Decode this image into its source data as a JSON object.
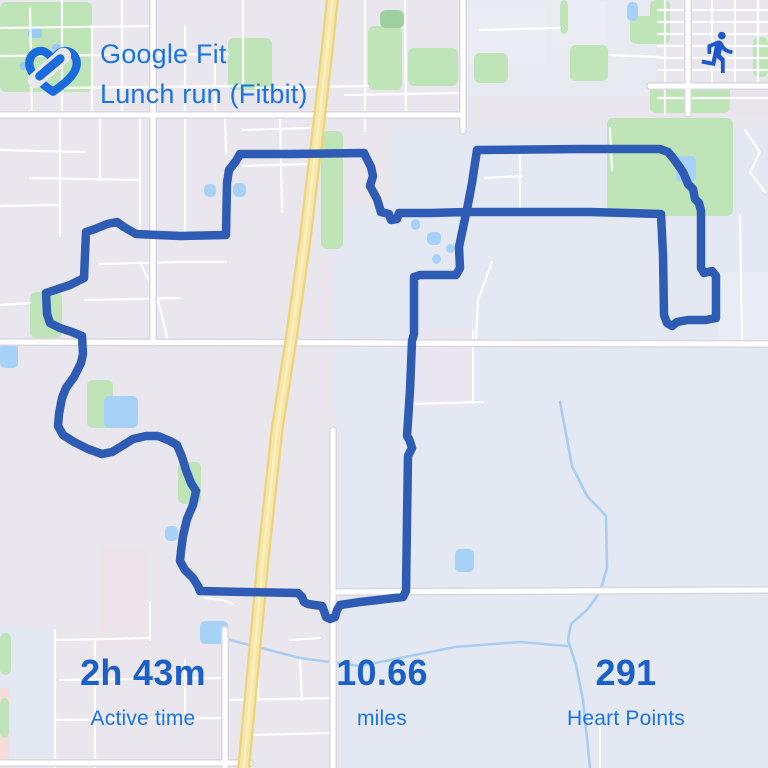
{
  "header": {
    "app_title": "Google Fit",
    "activity_title": "Lunch run (Fitbit)"
  },
  "icons": {
    "logo": "google-fit-heart-icon",
    "badge": "run-icon"
  },
  "stats": [
    {
      "value": "2h 43m",
      "label": "Active time"
    },
    {
      "value": "10.66",
      "label": "miles"
    },
    {
      "value": "291",
      "label": "Heart Points"
    }
  ],
  "colors": {
    "title_blue": "#1A73E8",
    "value_blue": "#1B5FC8",
    "label_blue": "#1A73E8",
    "logo_blue": "#1A6BDE",
    "run_icon_blue": "#1D57C9",
    "route_blue": "#2E5BB4",
    "map_base": "#E9E6EE",
    "map_water": "#A7D2F7",
    "map_park": "#BEE4B8",
    "map_road": "#FFFFFF",
    "map_road_casing": "#DBD7E1",
    "map_highway": "#F7E7A4",
    "map_highway_casing": "#EDD27F"
  },
  "map": {
    "zones": [
      [
        0,
        0,
        768,
        768,
        "#E9E6EE"
      ],
      [
        333,
        205,
        435,
        563,
        "#E3E8F2"
      ],
      [
        390,
        128,
        378,
        80,
        "#E4E8F2"
      ],
      [
        460,
        0,
        200,
        96,
        "#E8EAF2"
      ],
      [
        656,
        0,
        112,
        114,
        "#E8E5ED"
      ],
      [
        552,
        2,
        54,
        44,
        "#ECECF4"
      ],
      [
        468,
        8,
        78,
        56,
        "#ECECF4"
      ],
      [
        408,
        330,
        64,
        76,
        "#E9E6EF"
      ],
      [
        718,
        272,
        50,
        70,
        "#EAECF3"
      ],
      [
        0,
        628,
        55,
        140,
        "#E4E8F2"
      ],
      [
        0,
        688,
        10,
        80,
        "#F5DEDA"
      ],
      [
        100,
        547,
        45,
        100,
        "#ECE4E9"
      ]
    ],
    "parks": [
      [
        0,
        2,
        92,
        90
      ],
      [
        228,
        38,
        44,
        52
      ],
      [
        368,
        26,
        34,
        64
      ],
      [
        380,
        10,
        24,
        18,
        "#9FD09F"
      ],
      [
        408,
        48,
        50,
        38
      ],
      [
        474,
        53,
        34,
        30
      ],
      [
        560,
        0,
        8,
        34
      ],
      [
        630,
        16,
        28,
        28
      ],
      [
        570,
        45,
        38,
        36
      ],
      [
        607,
        118,
        126,
        98
      ],
      [
        650,
        0,
        20,
        44
      ],
      [
        753,
        37,
        15,
        40
      ],
      [
        650,
        85,
        80,
        28
      ],
      [
        321,
        131,
        22,
        118
      ],
      [
        30,
        292,
        32,
        46
      ],
      [
        87,
        380,
        26,
        48
      ],
      [
        178,
        462,
        23,
        42
      ],
      [
        0,
        633,
        11,
        42
      ],
      [
        0,
        698,
        9,
        40
      ]
    ],
    "ponds": [
      [
        676,
        156,
        20,
        26
      ],
      [
        627,
        2,
        11,
        19
      ],
      [
        0,
        343,
        18,
        25
      ],
      [
        104,
        396,
        34,
        32
      ],
      [
        165,
        526,
        13,
        15
      ],
      [
        200,
        621,
        28,
        23
      ],
      [
        455,
        549,
        19,
        23
      ],
      [
        427,
        232,
        14,
        13
      ],
      [
        446,
        244,
        9,
        9
      ],
      [
        432,
        254,
        9,
        10
      ],
      [
        411,
        219,
        9,
        11
      ],
      [
        204,
        184,
        12,
        13
      ],
      [
        233,
        183,
        13,
        14
      ]
    ],
    "pond_specks": [
      [
        28,
        28,
        14,
        10
      ],
      [
        52,
        44,
        10,
        8
      ],
      [
        20,
        62,
        9,
        8
      ]
    ],
    "creeks": [
      [
        [
          560,
          402
        ],
        [
          572,
          466
        ],
        [
          587,
          496
        ],
        [
          606,
          516
        ],
        [
          607,
          568
        ],
        [
          600,
          592
        ],
        [
          588,
          609
        ],
        [
          571,
          624
        ],
        [
          568,
          640
        ],
        [
          576,
          665
        ],
        [
          583,
          700
        ],
        [
          590,
          768
        ]
      ],
      [
        [
          410,
          656
        ],
        [
          455,
          647
        ],
        [
          520,
          642
        ],
        [
          567,
          646
        ]
      ],
      [
        [
          230,
          640
        ],
        [
          300,
          658
        ],
        [
          360,
          666
        ],
        [
          410,
          656
        ]
      ]
    ],
    "roads_minor": [
      [
        [
          0,
          28
        ],
        [
          150,
          26
        ]
      ],
      [
        [
          0,
          56
        ],
        [
          228,
          54
        ]
      ],
      [
        [
          60,
          88
        ],
        [
          240,
          86
        ]
      ],
      [
        [
          30,
          8
        ],
        [
          32,
          115
        ]
      ],
      [
        [
          62,
          0
        ],
        [
          62,
          115
        ]
      ],
      [
        [
          92,
          26
        ],
        [
          92,
          115
        ]
      ],
      [
        [
          122,
          0
        ],
        [
          122,
          115
        ]
      ],
      [
        [
          185,
          26
        ],
        [
          185,
          115
        ]
      ],
      [
        [
          215,
          54
        ],
        [
          215,
          115
        ]
      ],
      [
        [
          243,
          0
        ],
        [
          243,
          88
        ]
      ],
      [
        [
          0,
          150
        ],
        [
          85,
          152
        ]
      ],
      [
        [
          30,
          178
        ],
        [
          140,
          180
        ]
      ],
      [
        [
          0,
          206
        ],
        [
          60,
          205
        ]
      ],
      [
        [
          60,
          115
        ],
        [
          60,
          236
        ]
      ],
      [
        [
          100,
          115
        ],
        [
          100,
          180
        ]
      ],
      [
        [
          140,
          115
        ],
        [
          140,
          236
        ]
      ],
      [
        [
          185,
          115
        ],
        [
          185,
          236
        ]
      ],
      [
        [
          100,
          264
        ],
        [
          180,
          262
        ],
        [
          226,
          262
        ]
      ],
      [
        [
          85,
          300
        ],
        [
          180,
          298
        ]
      ],
      [
        [
          140,
          262
        ],
        [
          158,
          300
        ],
        [
          168,
          341
        ]
      ],
      [
        [
          225,
          115
        ],
        [
          226,
          154
        ]
      ],
      [
        [
          280,
          115
        ],
        [
          282,
          212
        ]
      ],
      [
        [
          243,
          130
        ],
        [
          310,
          128
        ]
      ],
      [
        [
          243,
          166
        ],
        [
          308,
          164
        ]
      ],
      [
        [
          365,
          0
        ],
        [
          365,
          131
        ]
      ],
      [
        [
          405,
          0
        ],
        [
          406,
          115
        ]
      ],
      [
        [
          255,
          88
        ],
        [
          368,
          86
        ]
      ],
      [
        [
          345,
          95
        ],
        [
          463,
          93
        ]
      ],
      [
        [
          480,
          30
        ],
        [
          560,
          28
        ]
      ],
      [
        [
          610,
          55
        ],
        [
          660,
          57
        ]
      ],
      [
        [
          658,
          10
        ],
        [
          768,
          10
        ]
      ],
      [
        [
          658,
          22
        ],
        [
          768,
          22
        ]
      ],
      [
        [
          658,
          34
        ],
        [
          768,
          34
        ]
      ],
      [
        [
          658,
          46
        ],
        [
          768,
          46
        ]
      ],
      [
        [
          658,
          58
        ],
        [
          768,
          58
        ]
      ],
      [
        [
          658,
          70
        ],
        [
          768,
          70
        ]
      ],
      [
        [
          658,
          98
        ],
        [
          768,
          98
        ]
      ],
      [
        [
          712,
          0
        ],
        [
          712,
          86
        ]
      ],
      [
        [
          735,
          0
        ],
        [
          735,
          86
        ]
      ],
      [
        [
          758,
          0
        ],
        [
          758,
          86
        ]
      ],
      [
        [
          665,
          0
        ],
        [
          665,
          114
        ]
      ],
      [
        [
          520,
          150
        ],
        [
          520,
          212
        ]
      ],
      [
        [
          485,
          178
        ],
        [
          522,
          176
        ]
      ],
      [
        [
          610,
          128
        ],
        [
          612,
          170
        ]
      ],
      [
        [
          740,
          215
        ],
        [
          742,
          340
        ]
      ],
      [
        [
          745,
          130
        ],
        [
          760,
          152
        ],
        [
          750,
          172
        ],
        [
          765,
          192
        ]
      ],
      [
        [
          492,
          262
        ],
        [
          478,
          300
        ],
        [
          476,
          341
        ]
      ],
      [
        [
          408,
          404
        ],
        [
          483,
          402
        ]
      ],
      [
        [
          473,
          330
        ],
        [
          473,
          403
        ]
      ],
      [
        [
          95,
          640
        ],
        [
          95,
          768
        ]
      ],
      [
        [
          55,
          640
        ],
        [
          150,
          638
        ]
      ],
      [
        [
          60,
          680
        ],
        [
          225,
          678
        ]
      ],
      [
        [
          55,
          720
        ],
        [
          225,
          718
        ]
      ],
      [
        [
          150,
          602
        ],
        [
          150,
          640
        ]
      ],
      [
        [
          185,
          660
        ],
        [
          185,
          720
        ]
      ],
      [
        [
          258,
          630
        ],
        [
          258,
          700
        ]
      ],
      [
        [
          230,
          700
        ],
        [
          330,
          698
        ]
      ],
      [
        [
          250,
          735
        ],
        [
          333,
          733
        ]
      ],
      [
        [
          205,
          598
        ],
        [
          222,
          600
        ],
        [
          233,
          604
        ]
      ],
      [
        [
          290,
          640
        ],
        [
          320,
          638
        ]
      ],
      [
        [
          300,
          660
        ],
        [
          302,
          700
        ]
      ],
      [
        [
          600,
          714
        ],
        [
          600,
          768
        ]
      ],
      [
        [
          55,
          630
        ],
        [
          55,
          768
        ]
      ],
      [
        [
          0,
          305
        ],
        [
          30,
          303
        ]
      ]
    ],
    "roads_major": [
      [
        [
          0,
          115
        ],
        [
          463,
          115
        ]
      ],
      [
        [
          650,
          86
        ],
        [
          768,
          86
        ]
      ],
      [
        [
          0,
          342
        ],
        [
          768,
          344
        ]
      ],
      [
        [
          333,
          592
        ],
        [
          768,
          590
        ]
      ],
      [
        [
          0,
          763
        ],
        [
          250,
          763
        ]
      ],
      [
        [
          153,
          0
        ],
        [
          153,
          343
        ]
      ],
      [
        [
          463,
          0
        ],
        [
          463,
          131
        ]
      ],
      [
        [
          688,
          0
        ],
        [
          688,
          114
        ]
      ],
      [
        [
          333,
          430
        ],
        [
          333,
          768
        ]
      ],
      [
        [
          225,
          630
        ],
        [
          225,
          768
        ]
      ]
    ],
    "highway": [
      [
        333,
        -6
      ],
      [
        326,
        60
      ],
      [
        318,
        130
      ],
      [
        305,
        240
      ],
      [
        291,
        340
      ],
      [
        277,
        430
      ],
      [
        263,
        560
      ],
      [
        251,
        690
      ],
      [
        243,
        775
      ]
    ],
    "route": [
      [
        477,
        150
      ],
      [
        580,
        149
      ],
      [
        660,
        149
      ],
      [
        668,
        152
      ],
      [
        673,
        158
      ],
      [
        681,
        169
      ],
      [
        684,
        174
      ],
      [
        688,
        184
      ],
      [
        693,
        189
      ],
      [
        695,
        199
      ],
      [
        699,
        203
      ],
      [
        701,
        211
      ],
      [
        701,
        245
      ],
      [
        701,
        268
      ],
      [
        704,
        273
      ],
      [
        712,
        271
      ],
      [
        716,
        276
      ],
      [
        716,
        318
      ],
      [
        706,
        320
      ],
      [
        688,
        320
      ],
      [
        677,
        322
      ],
      [
        672,
        326
      ],
      [
        667,
        323
      ],
      [
        664,
        315
      ],
      [
        663,
        255
      ],
      [
        661,
        214
      ],
      [
        590,
        212
      ],
      [
        480,
        212
      ],
      [
        466,
        212
      ],
      [
        430,
        213
      ],
      [
        399,
        213
      ],
      [
        397,
        219
      ],
      [
        391,
        220
      ],
      [
        389,
        214
      ],
      [
        381,
        212
      ],
      [
        377,
        199
      ],
      [
        370,
        186
      ],
      [
        373,
        176
      ],
      [
        371,
        167
      ],
      [
        364,
        153
      ],
      [
        290,
        154
      ],
      [
        240,
        154
      ],
      [
        236,
        161
      ],
      [
        229,
        170
      ],
      [
        227,
        183
      ],
      [
        226,
        235
      ],
      [
        180,
        236
      ],
      [
        136,
        234
      ],
      [
        124,
        227
      ],
      [
        117,
        222
      ],
      [
        107,
        224
      ],
      [
        95,
        229
      ],
      [
        86,
        232
      ],
      [
        84,
        278
      ],
      [
        70,
        285
      ],
      [
        55,
        290
      ],
      [
        46,
        293
      ],
      [
        47,
        314
      ],
      [
        50,
        323
      ],
      [
        60,
        328
      ],
      [
        72,
        332
      ],
      [
        82,
        336
      ],
      [
        83,
        354
      ],
      [
        81,
        363
      ],
      [
        74,
        377
      ],
      [
        66,
        388
      ],
      [
        62,
        398
      ],
      [
        59,
        414
      ],
      [
        58,
        426
      ],
      [
        63,
        435
      ],
      [
        74,
        442
      ],
      [
        88,
        449
      ],
      [
        102,
        454
      ],
      [
        112,
        452
      ],
      [
        122,
        446
      ],
      [
        133,
        439
      ],
      [
        146,
        436
      ],
      [
        158,
        436
      ],
      [
        170,
        441
      ],
      [
        177,
        445
      ],
      [
        182,
        457
      ],
      [
        186,
        470
      ],
      [
        191,
        483
      ],
      [
        196,
        491
      ],
      [
        193,
        505
      ],
      [
        187,
        519
      ],
      [
        183,
        536
      ],
      [
        181,
        551
      ],
      [
        180,
        561
      ],
      [
        185,
        570
      ],
      [
        193,
        578
      ],
      [
        198,
        586
      ],
      [
        200,
        591
      ],
      [
        245,
        592
      ],
      [
        298,
        593
      ],
      [
        302,
        597
      ],
      [
        304,
        602
      ],
      [
        308,
        604
      ],
      [
        315,
        605
      ],
      [
        322,
        606
      ],
      [
        324,
        611
      ],
      [
        326,
        617
      ],
      [
        330,
        619
      ],
      [
        335,
        617
      ],
      [
        337,
        610
      ],
      [
        340,
        605
      ],
      [
        360,
        602
      ],
      [
        378,
        600
      ],
      [
        403,
        597
      ],
      [
        406,
        591
      ],
      [
        407,
        520
      ],
      [
        408,
        456
      ],
      [
        412,
        448
      ],
      [
        409,
        439
      ],
      [
        407,
        436
      ],
      [
        410,
        390
      ],
      [
        412,
        341
      ],
      [
        414,
        334
      ],
      [
        414,
        277
      ],
      [
        420,
        275
      ],
      [
        445,
        275
      ],
      [
        456,
        275
      ],
      [
        460,
        268
      ],
      [
        459,
        247
      ],
      [
        463,
        228
      ],
      [
        466,
        214
      ],
      [
        469,
        199
      ],
      [
        472,
        183
      ],
      [
        477,
        150
      ]
    ]
  }
}
